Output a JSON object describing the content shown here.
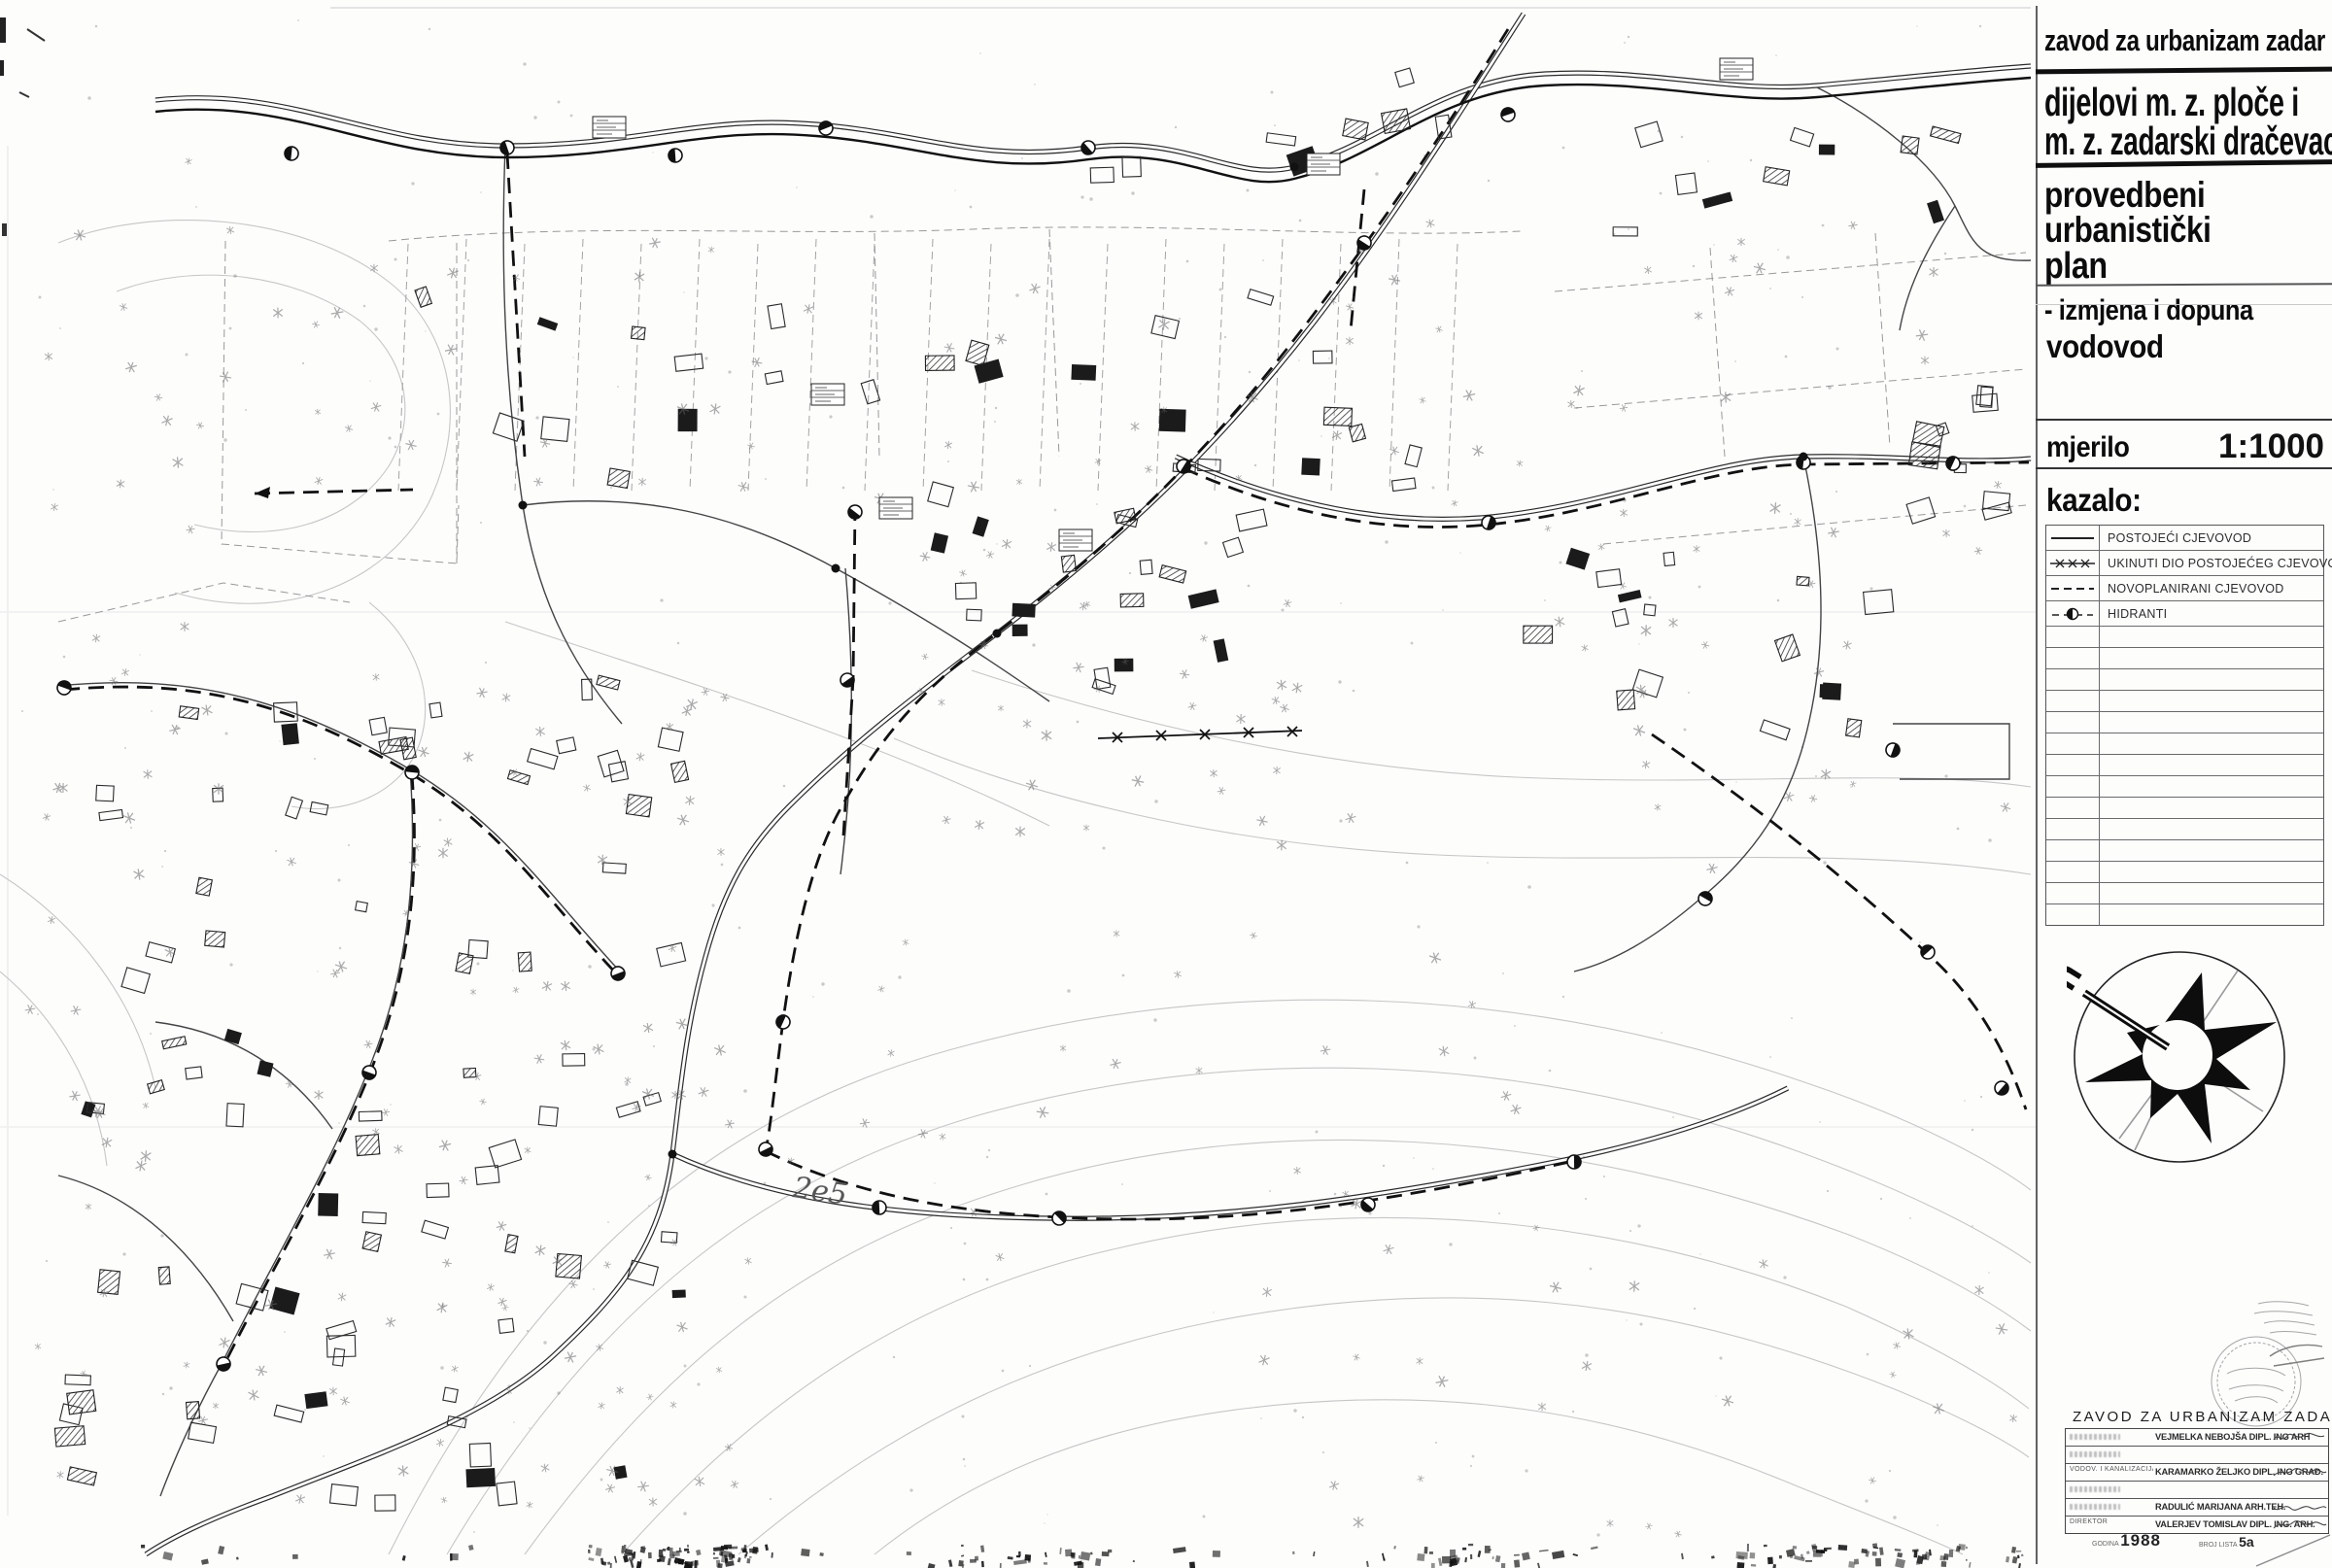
{
  "title_block": {
    "agency": "zavod za urbanizam zadar",
    "area_line1": "dijelovi m. z. ploče i",
    "area_line2": "m. z. zadarski dračevac",
    "plan_line1": "provedbeni",
    "plan_line2": "urbanistički",
    "plan_line3_strong": "plan",
    "plan_line3_rest": "- izmjena i dopuna",
    "sheet_subject": "vodovod",
    "scale_label": "mjerilo",
    "scale_value": "1:1000",
    "legend_label": "kazalo:"
  },
  "legend": {
    "items": [
      {
        "symbol": "solid-line",
        "label": "POSTOJEĆI CJEVOVOD"
      },
      {
        "symbol": "x-marked-line",
        "label": "UKINUTI DIO POSTOJEĆEG CJEVOVODA"
      },
      {
        "symbol": "dashed-line",
        "label": "NOVOPLANIRANI CJEVOVOD"
      },
      {
        "symbol": "hydrant",
        "label": "HIDRANTI"
      }
    ],
    "empty_rows": 14
  },
  "compass": {
    "north_letter": "n"
  },
  "map": {
    "annotation": "2e5"
  },
  "signature_block": {
    "header": "ZAVOD ZA URBANIZAM ZADAR",
    "rows": [
      {
        "role": "",
        "name": "VEJMELKA NEBOJŠA DIPL. ING ARH"
      },
      {
        "role": "",
        "name": ""
      },
      {
        "role": "VODOV. I KANALIZACIJA",
        "name": "KARAMARKO ŽELJKO DIPL. ING GRAĐ."
      },
      {
        "role": "",
        "name": ""
      },
      {
        "role": "",
        "name": "RADULIĆ MARIJANA ARH.TEH."
      },
      {
        "role": "DIREKTOR",
        "name": "VALERJEV TOMISLAV DIPL. ING. ARH."
      }
    ],
    "year_label": "GODINA",
    "year": "1988",
    "sheet_label": "BROJ LISTA",
    "sheet_number": "5a"
  },
  "colors": {
    "ink": "#111111",
    "contour": "#c6c6c6",
    "parcel": "#999999"
  }
}
